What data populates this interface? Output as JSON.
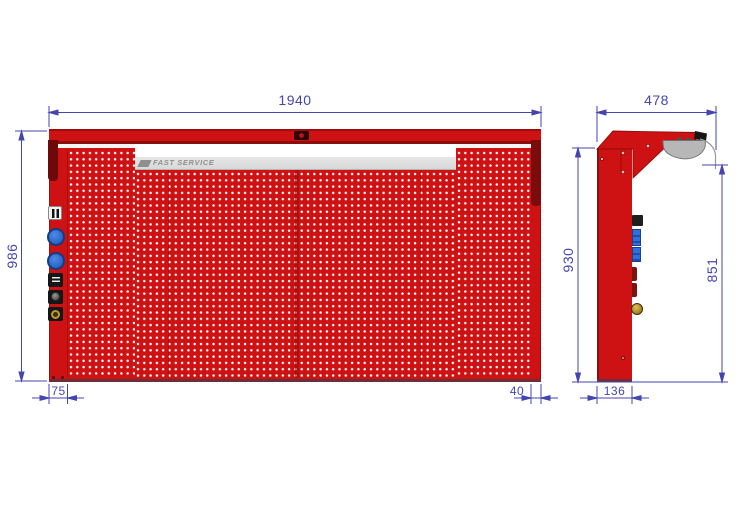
{
  "colors": {
    "red": "#ce1112",
    "red_dark": "#8c0d0d",
    "maroon": "#6e0909",
    "dim": "#4545b0",
    "lamp": "#b7b7b7",
    "socket_blue": "#2f6fd8",
    "label_strip": "#d8d8d8",
    "logo_gray": "#8f8f8f",
    "brass": "#c09a30"
  },
  "brand": {
    "label": "FAST SERVICE"
  },
  "front_view": {
    "dims": {
      "overall_width": "1940",
      "overall_height": "986",
      "left_column_width": "75",
      "right_margin": "40"
    }
  },
  "side_view": {
    "dims": {
      "overall_depth": "478",
      "panel_height": "930",
      "lamp_clearance": "851",
      "base_depth": "136"
    }
  }
}
